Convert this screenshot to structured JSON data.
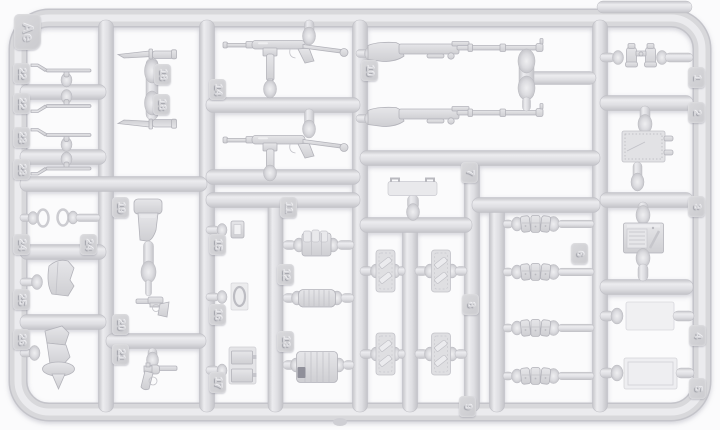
{
  "scene": {
    "type": "plastic-model-kit-sprue-photo",
    "sprue_letter": "Ae",
    "description": "Light grey injection-moulded sprue of WWII German infantry weapons and equipment on a white background"
  },
  "colors": {
    "background": "#fbfbfc",
    "plastic_base": "#d6d6d9",
    "plastic_highlight": "#ededf0",
    "plastic_edge": "#bfbfc5",
    "tag_plate": "#d2d2d6",
    "tag_numeral": "#d6d6da",
    "dark_patch": "#90909a"
  },
  "tags": [
    {
      "label": "Ae"
    },
    {
      "label": "22"
    },
    {
      "label": "22"
    },
    {
      "label": "23"
    },
    {
      "label": "23"
    },
    {
      "label": "18"
    },
    {
      "label": "18"
    },
    {
      "label": "14"
    },
    {
      "label": "10"
    },
    {
      "label": "1"
    },
    {
      "label": "2"
    },
    {
      "label": "3"
    },
    {
      "label": "24"
    },
    {
      "label": "24"
    },
    {
      "label": "25"
    },
    {
      "label": "26"
    },
    {
      "label": "19"
    },
    {
      "label": "20"
    },
    {
      "label": "21"
    },
    {
      "label": "15"
    },
    {
      "label": "16"
    },
    {
      "label": "17"
    },
    {
      "label": "11"
    },
    {
      "label": "12"
    },
    {
      "label": "13"
    },
    {
      "label": "7"
    },
    {
      "label": "8"
    },
    {
      "label": "9"
    },
    {
      "label": "6"
    },
    {
      "label": "4"
    },
    {
      "label": "5"
    }
  ],
  "parts": [
    {
      "number": "1",
      "item": "binoculars",
      "count": 1
    },
    {
      "number": "2",
      "item": "riveted equipment plate",
      "count": 1
    },
    {
      "number": "3",
      "item": "field radio box",
      "count": 1
    },
    {
      "number": "4",
      "item": "flat panel",
      "count": 1
    },
    {
      "number": "5",
      "item": "framed flat panel",
      "count": 1
    },
    {
      "number": "6",
      "item": "triple rifle ammo pouch",
      "count": 4
    },
    {
      "number": "7",
      "item": "lid with two handles",
      "count": 1
    },
    {
      "number": "8",
      "item": "strapped case panel",
      "count": 2
    },
    {
      "number": "9",
      "item": "strapped case panel",
      "count": 2
    },
    {
      "number": "10",
      "item": "Kar98k rifle",
      "count": 2
    },
    {
      "number": "11",
      "item": "magazine pouch",
      "count": 1
    },
    {
      "number": "12",
      "item": "gas mask canister",
      "count": 1
    },
    {
      "number": "13",
      "item": "large ribbed canister",
      "count": 1
    },
    {
      "number": "14",
      "item": "MP40 submachine gun",
      "count": 2
    },
    {
      "number": "15",
      "item": "small buckle",
      "count": 1
    },
    {
      "number": "16",
      "item": "oval ring on plate",
      "count": 1
    },
    {
      "number": "17",
      "item": "twin ammunition boxes",
      "count": 1
    },
    {
      "number": "18",
      "item": "bayonet",
      "count": 2
    },
    {
      "number": "19",
      "item": "pistol holster",
      "count": 1
    },
    {
      "number": "20",
      "item": "pistol",
      "count": 1
    },
    {
      "number": "21",
      "item": "revolver",
      "count": 1
    },
    {
      "number": "22",
      "item": "cleaning tool",
      "count": 2
    },
    {
      "number": "23",
      "item": "cleaning tool",
      "count": 2
    },
    {
      "number": "24",
      "item": "oval ring",
      "count": 2
    },
    {
      "number": "25",
      "item": "holster flap",
      "count": 1
    },
    {
      "number": "26",
      "item": "holster with cover",
      "count": 1
    }
  ]
}
